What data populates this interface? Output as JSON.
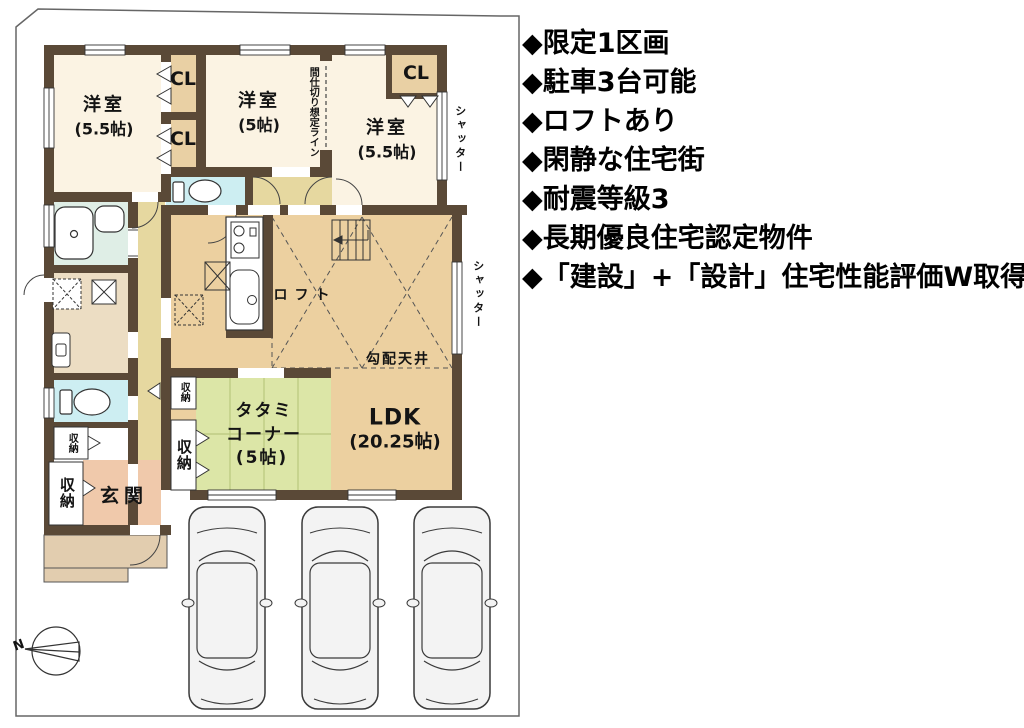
{
  "plan": {
    "rooms": {
      "bedroom1": {
        "name": "洋室",
        "size": "(5.5帖)"
      },
      "bedroom2": {
        "name": "洋室",
        "size": "(5帖)"
      },
      "bedroom3": {
        "name": "洋室",
        "size": "(5.5帖)"
      },
      "ldk": {
        "name": "LDK",
        "size": "(20.25帖)"
      },
      "tatami": {
        "line1": "タタミ",
        "line2": "コーナー",
        "line3": "(5帖)"
      },
      "genkan": "玄関"
    },
    "labels": {
      "cl1": "CL",
      "cl2": "CL",
      "cl3": "CL",
      "shutter1": "シャッター",
      "shutter2": "シャッター",
      "partition": "間仕切り想定ライン",
      "loft": "ロフト",
      "sloped_ceiling": "勾配天井",
      "storage_tatami_small": "収納",
      "storage_tatami_big": "収納",
      "storage_entry_small": "収納",
      "storage_entry_big": "収納",
      "compass_n": "N"
    },
    "colors": {
      "wall": "#5a4937",
      "bedroom": "#fbf3e3",
      "closet": "#e9d0a4",
      "hall": "#e6d8a0",
      "ldk": "#ecd0a0",
      "tatami": "#dce6a7",
      "bath": "#dfeee6",
      "toilet": "#cdeef2",
      "genkan": "#f0c9ab",
      "porch": "#e2cdaf"
    }
  },
  "features": {
    "items": [
      "◆限定1区画",
      "◆駐車3台可能",
      "◆ロフトあり",
      "◆閑静な住宅街",
      "◆耐震等級3",
      "◆長期優良住宅認定物件",
      "◆「建設」+「設計」住宅性能評価W取得"
    ]
  }
}
